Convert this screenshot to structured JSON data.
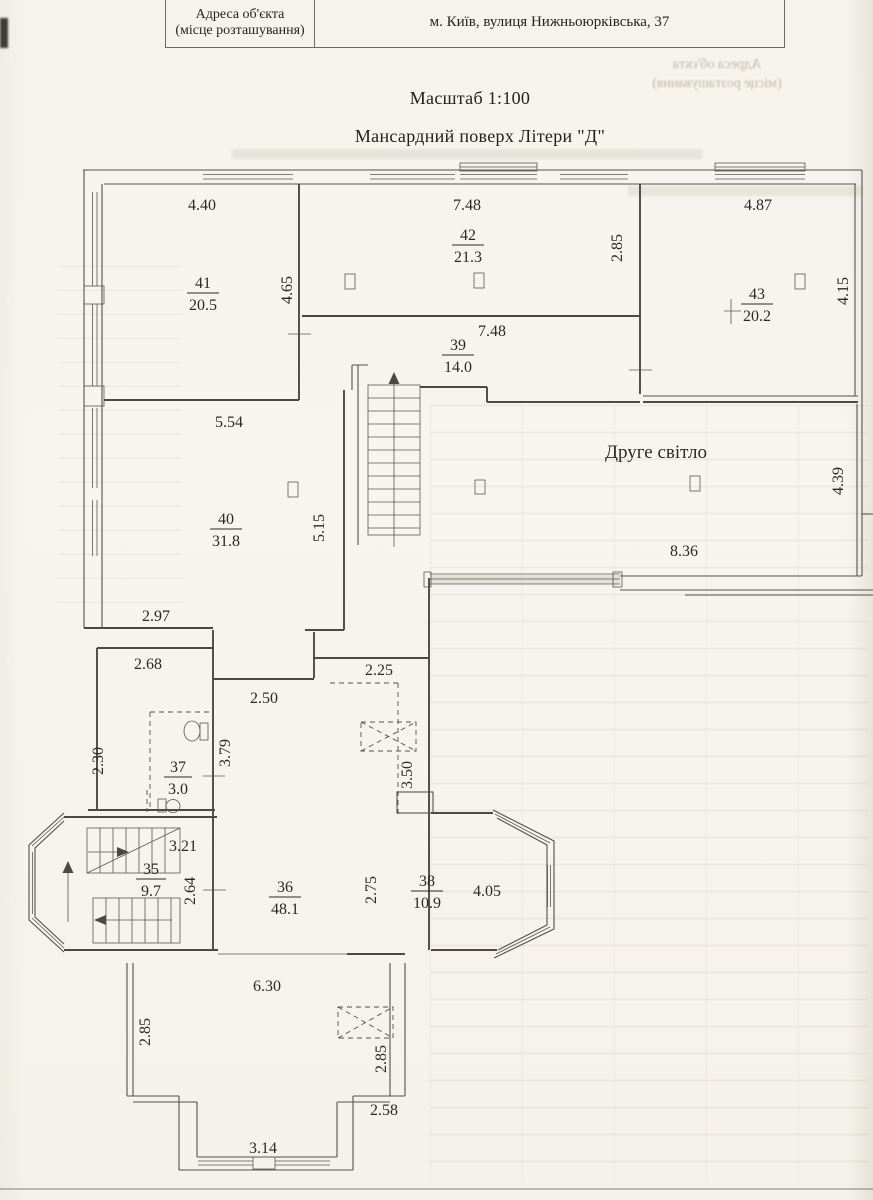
{
  "page": {
    "header_table": {
      "label_line1": "Адреса об'єкта",
      "label_line2": "(місце розташування)",
      "value": "м. Київ, вулиця Нижньоюрківська, 37"
    },
    "scale_title": "Масштаб 1:100",
    "plan_title": "Мансардний поверх Літери \"Д\"",
    "second_light": "Друге світло"
  },
  "rooms": {
    "r41": {
      "number": "41",
      "area": "20.5"
    },
    "r42": {
      "number": "42",
      "area": "21.3"
    },
    "r43": {
      "number": "43",
      "area": "20.2"
    },
    "r39": {
      "number": "39",
      "area": "14.0"
    },
    "r40": {
      "number": "40",
      "area": "31.8"
    },
    "r37": {
      "number": "37",
      "area": "3.0"
    },
    "r35": {
      "number": "35",
      "area": "9.7"
    },
    "r36": {
      "number": "36",
      "area": "48.1"
    },
    "r38": {
      "number": "38",
      "area": "10.9"
    }
  },
  "dims": {
    "t41": "4.40",
    "t42": "7.48",
    "t43": "4.87",
    "v41": "4.65",
    "v42": "2.85",
    "v43": "4.15",
    "m39": "7.48",
    "t40": "5.54",
    "v40": "5.15",
    "sl_w": "8.36",
    "sl_h": "4.39",
    "d297": "2.97",
    "d268": "2.68",
    "d250": "2.50",
    "d225": "2.25",
    "d230": "2.30",
    "d379": "3.79",
    "d350": "3.50",
    "d321": "3.21",
    "d264": "2.64",
    "d275": "2.75",
    "d405": "4.05",
    "d630": "6.30",
    "d285l": "2.85",
    "d285r": "2.85",
    "d258": "2.58",
    "d314": "3.14"
  }
}
